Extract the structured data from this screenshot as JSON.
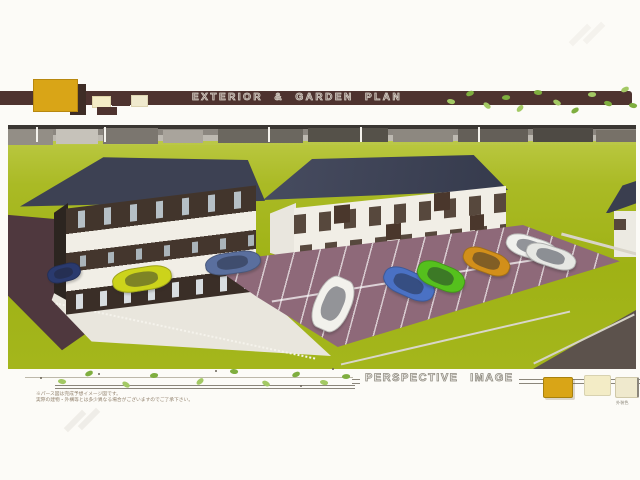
{
  "doc": {
    "header": {
      "title": "EXTERIOR & GARDEN PLAN"
    },
    "footer": {
      "caption": "PERSPECTIVE IMAGE",
      "disclaimer_line1": "※パース図は完成予想イメージ図です。",
      "disclaimer_line2": "実際の建物・外構等とは多少異なる場合がございますのでご了承下さい。",
      "swatch_caption": "外装色"
    },
    "colors": {
      "banner_brown": "#4e332f",
      "accent_gold": "#d9a517",
      "accent_cream": "#f3ecc6",
      "accent_pale_yellow": "#efe9cd",
      "lawn_green": "#a3b51c",
      "roof_navy": "#3d4153",
      "wall_dark_brown": "#42352c",
      "wall_white": "#f1eee6",
      "parking_mauve": "#8e6979",
      "concrete": "#e9e6dd",
      "driveway_maroon": "#4f383e",
      "vine_green": "#8fbc4e"
    },
    "scene": {
      "description": "Aerial perspective rendering of two apartment buildings with lawn, driveway and parking lot",
      "buildings": [
        {
          "name": "left-apartment",
          "floors": 3,
          "style": "dark brown walls with white balcony bands",
          "roof": "navy hip roof"
        },
        {
          "name": "right-apartment",
          "floors": 2,
          "style": "white walls with brown accent panels",
          "roof": "navy hip roof"
        },
        {
          "name": "neighbor-building",
          "floors": 2,
          "style": "white walls",
          "roof": "navy roof"
        }
      ],
      "cars": [
        {
          "name": "navy-hatchback",
          "color": "#2a3a6e",
          "x": 39,
          "y": 139,
          "w": 32,
          "h": 16,
          "rot": -14
        },
        {
          "name": "yellow-hatchback",
          "color": "#ccd31b",
          "x": 104,
          "y": 142,
          "w": 58,
          "h": 22,
          "rot": -9
        },
        {
          "name": "steel-blue-sedan",
          "color": "#5a6f9e",
          "x": 197,
          "y": 127,
          "w": 54,
          "h": 20,
          "rot": -8
        },
        {
          "name": "white-minivan",
          "color": "#f2f1ec",
          "x": 307,
          "y": 151,
          "w": 34,
          "h": 54,
          "rot": 24
        },
        {
          "name": "blue-hatchback",
          "color": "#4a71c4",
          "x": 374,
          "y": 146,
          "w": 52,
          "h": 24,
          "rot": 24
        },
        {
          "name": "green-hatchback",
          "color": "#55c01d",
          "x": 408,
          "y": 139,
          "w": 48,
          "h": 23,
          "rot": 22
        },
        {
          "name": "orange-coupe",
          "color": "#d28f1a",
          "x": 454,
          "y": 125,
          "w": 47,
          "h": 21,
          "rot": 20
        },
        {
          "name": "white-sedan",
          "color": "#f0f0ed",
          "x": 497,
          "y": 112,
          "w": 52,
          "h": 20,
          "rot": 18
        },
        {
          "name": "white-sedan-2",
          "color": "#e6e7e3",
          "x": 517,
          "y": 121,
          "w": 50,
          "h": 19,
          "rot": 18
        }
      ]
    },
    "decor": {
      "banner_leaves": [
        {
          "x": 447,
          "y": 99,
          "rot": 25
        },
        {
          "x": 466,
          "y": 91,
          "rot": -10
        },
        {
          "x": 483,
          "y": 103,
          "rot": 50
        },
        {
          "x": 502,
          "y": 95,
          "rot": 8
        },
        {
          "x": 516,
          "y": 106,
          "rot": -35
        },
        {
          "x": 534,
          "y": 90,
          "rot": 15
        },
        {
          "x": 553,
          "y": 100,
          "rot": 40
        },
        {
          "x": 571,
          "y": 108,
          "rot": -20
        },
        {
          "x": 588,
          "y": 92,
          "rot": 10
        },
        {
          "x": 604,
          "y": 101,
          "rot": 30
        },
        {
          "x": 621,
          "y": 87,
          "rot": -15
        },
        {
          "x": 629,
          "y": 103,
          "rot": 20
        }
      ],
      "footer_marks": [
        {
          "x": 58,
          "y": 379,
          "rot": 20
        },
        {
          "x": 85,
          "y": 371,
          "rot": -15
        },
        {
          "x": 122,
          "y": 382,
          "rot": 45
        },
        {
          "x": 150,
          "y": 373,
          "rot": 5
        },
        {
          "x": 196,
          "y": 379,
          "rot": -30
        },
        {
          "x": 230,
          "y": 369,
          "rot": 18
        },
        {
          "x": 262,
          "y": 381,
          "rot": 40
        },
        {
          "x": 292,
          "y": 372,
          "rot": -12
        },
        {
          "x": 320,
          "y": 380,
          "rot": 25
        },
        {
          "x": 342,
          "y": 374,
          "rot": 8
        },
        {
          "x": 40,
          "y": 377,
          "t": "dot"
        },
        {
          "x": 98,
          "y": 373,
          "t": "dot"
        },
        {
          "x": 215,
          "y": 370,
          "t": "dot"
        },
        {
          "x": 300,
          "y": 385,
          "t": "dot"
        },
        {
          "x": 332,
          "y": 368,
          "t": "dot"
        }
      ]
    }
  }
}
